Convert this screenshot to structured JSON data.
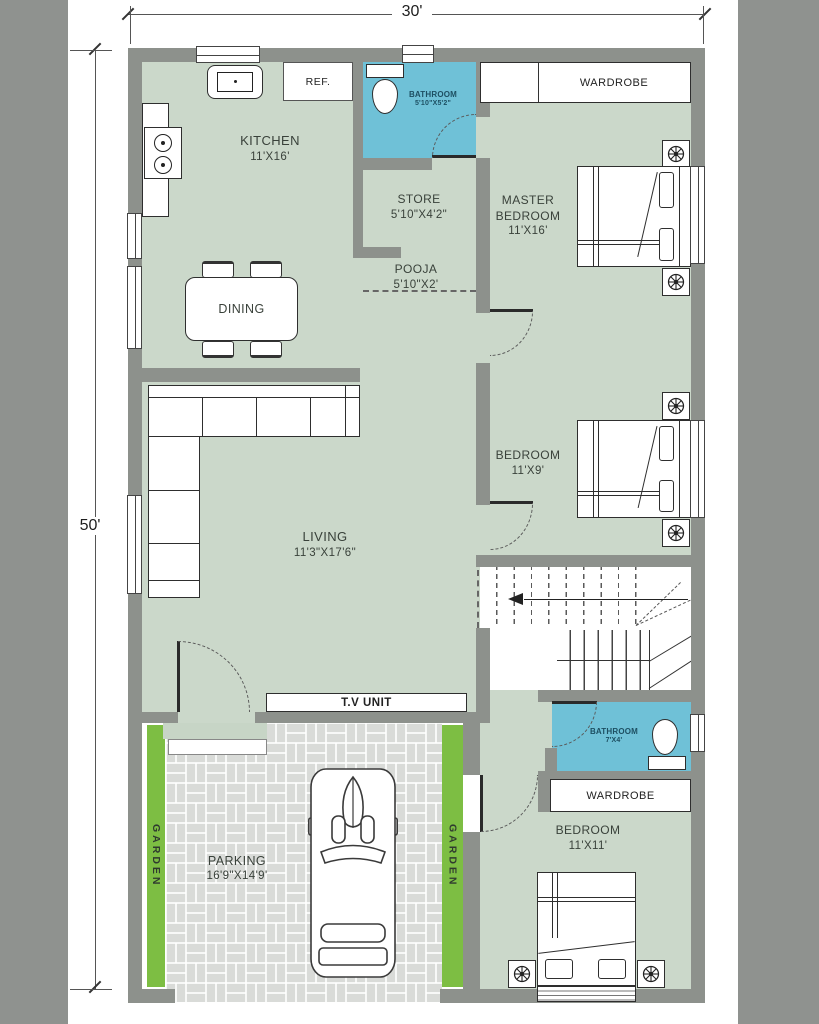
{
  "dimensions": {
    "width_label": "30'",
    "height_label": "50'"
  },
  "rooms": {
    "kitchen": {
      "name": "KITCHEN",
      "size": "11'X16'"
    },
    "store": {
      "name": "STORE",
      "size": "5'10\"X4'2\""
    },
    "pooja": {
      "name": "POOJA",
      "size": "5'10\"X2'"
    },
    "dining": {
      "name": "DINING"
    },
    "living": {
      "name": "LIVING",
      "size": "11'3\"X17'6\""
    },
    "master_bedroom": {
      "name": "MASTER BEDROOM",
      "size": "11'X16'"
    },
    "bedroom_mid": {
      "name": "BEDROOM",
      "size": "11'X9'"
    },
    "bedroom_bottom": {
      "name": "BEDROOM",
      "size": "11'X11'"
    },
    "bathroom_top": {
      "name": "BATHROOM",
      "size": "5'10\"X5'2\""
    },
    "bathroom_bottom": {
      "name": "BATHROOM",
      "size": "7'X4'"
    },
    "parking": {
      "name": "PARKING",
      "size": "16'9\"X14'9'"
    },
    "garden": {
      "name": "GARDEN"
    }
  },
  "fixtures": {
    "ref": "REF.",
    "tv_unit": "T.V UNIT",
    "wardrobe_top": "WARDROBE",
    "wardrobe_bottom": "WARDROBE"
  },
  "colors": {
    "floor": "#cbd8ca",
    "wall": "#8d918c",
    "bathroom": "#6fc1d7",
    "garden": "#7dbe43",
    "paving": "#d9dbd8",
    "side_band": "#8f928f"
  }
}
